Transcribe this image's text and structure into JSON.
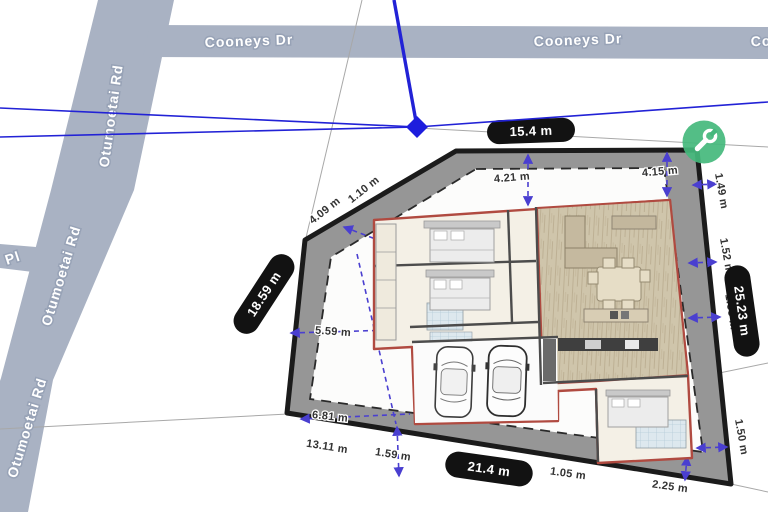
{
  "view": {
    "type": "site-plan-map-viewer"
  },
  "roads": {
    "cooneys_dr": "Cooneys Dr",
    "otumoetai_rd": "Otumoetai Rd",
    "pl_abbrev": "Pl"
  },
  "boundary_pills": {
    "top": "15.4 m",
    "left": "18.59 m",
    "bottom": "21.4 m",
    "right": "25.23 m"
  },
  "setbacks": {
    "diag_a": "4.09 m",
    "diag_b": "1.10 m",
    "top_left": "4.21 m",
    "top_right": "4.15 m",
    "right_upper": "1.49 m",
    "right_mid": "1.52 m",
    "right_hidden": "1.53 m",
    "right_lower": "1.50 m",
    "left_mid": "5.59 m",
    "left_lower": "6.81 m",
    "bottom_left": "13.11 m",
    "bottom_mid": "1.59 m",
    "bottom_right_a": "1.05 m",
    "bottom_right_b": "2.25 m"
  },
  "tool_button": {
    "icon": "wrench"
  },
  "colors": {
    "road_fill": "#a9b2c3",
    "parcel_band": "#969696",
    "boundary_stroke": "#1b1b1b",
    "lot_interior": "#fcfcfb",
    "building_outline": "#b04a40",
    "building_fill": "#f4f0e6",
    "timber_floor": "#cfc5ab",
    "overlay_blue": "#2222d6",
    "arrow_blue": "#4a3fd0",
    "pill_bg": "#121212",
    "pill_text": "#ffffff",
    "tool_button_green": "#44b87c"
  }
}
